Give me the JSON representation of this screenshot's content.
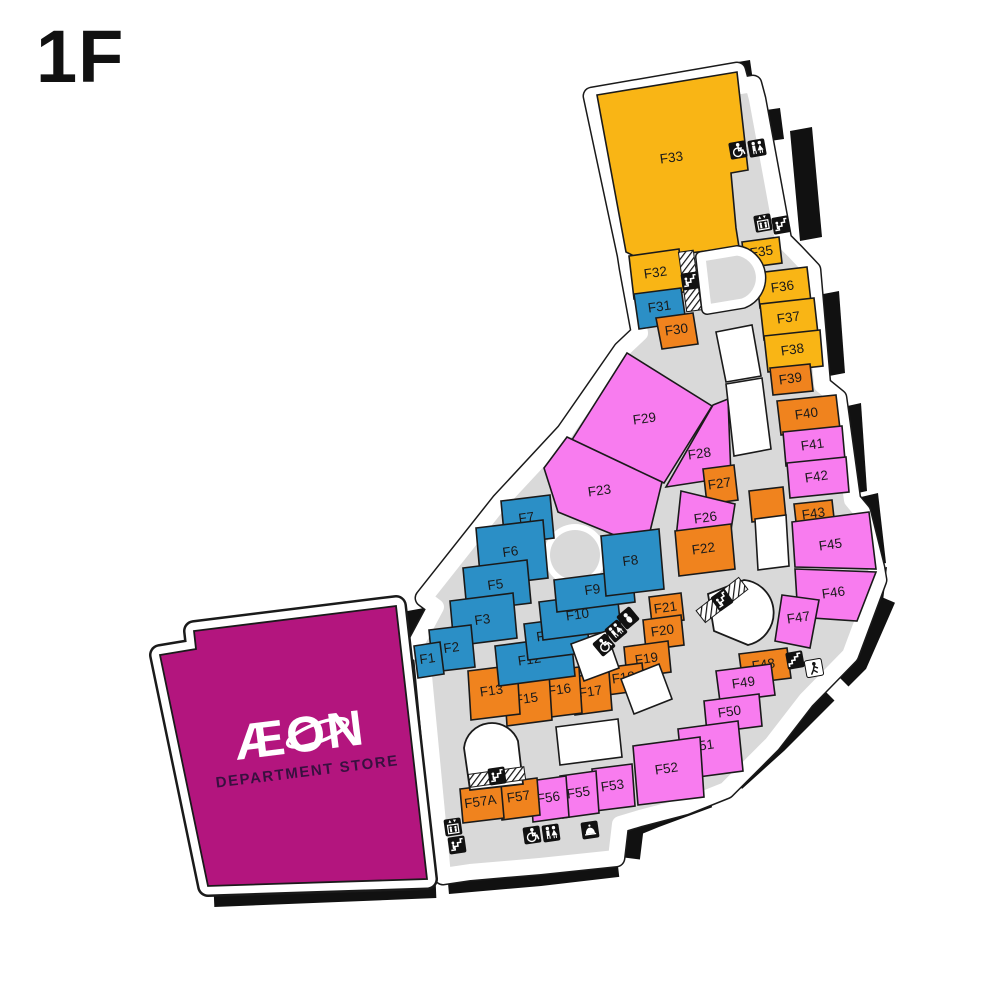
{
  "page": {
    "floor_label": "1F"
  },
  "palette": {
    "yellow": "#F9B515",
    "orange": "#F0831E",
    "blue": "#2B8FC6",
    "pink": "#F87CEF",
    "magenta": "#B3157E",
    "corridor": "#D9D9D9",
    "wall": "#111111",
    "outline": "#1A1A1A",
    "white": "#FFFFFF"
  },
  "aeon": {
    "logo": "ÆON",
    "subtitle": "DEPARTMENT STORE",
    "points": "160,655 196,649 194,631 396,606 427,879 208,886",
    "logo_x": 300,
    "logo_y": 752,
    "sub_x": 303,
    "sub_y": 777,
    "rot": -7
  },
  "footprint": {
    "points": "592,96 737,71 741,86 753,84 757,99 783,240 795,252 812,270 822,385 838,398 852,500 862,512 876,568 878,580 850,655 806,700 772,744 726,790 686,806 640,818 620,824 616,858 540,866 470,872 443,876 422,655 413,650 436,607 424,598 500,502 565,432 622,350 640,333 628,268 626,255"
  },
  "units": [
    {
      "id": "F33",
      "color": "yellow",
      "points": "597,95 737,72 748,170 731,173 736,228 739,247 640,259 626,252",
      "lx": 672,
      "ly": 162
    },
    {
      "id": "F32",
      "color": "yellow",
      "points": "629,256 679,249 684,292 634,299",
      "lx": 656,
      "ly": 277
    },
    {
      "id": "F35",
      "color": "yellow",
      "points": "742,242 779,237 782,263 745,268",
      "lx": 762,
      "ly": 256
    },
    {
      "id": "F36",
      "color": "yellow",
      "points": "756,273 807,267 811,302 760,308",
      "lx": 783,
      "ly": 291
    },
    {
      "id": "F37",
      "color": "yellow",
      "points": "760,304 814,298 818,334 764,340",
      "lx": 789,
      "ly": 322
    },
    {
      "id": "F38",
      "color": "yellow",
      "points": "764,336 820,330 823,366 768,372",
      "lx": 793,
      "ly": 354
    },
    {
      "id": "F39",
      "color": "orange",
      "points": "770,368 810,364 813,391 773,395",
      "lx": 791,
      "ly": 383
    },
    {
      "id": "F40",
      "color": "orange",
      "points": "777,401 836,395 840,429 781,435",
      "lx": 807,
      "ly": 418
    },
    {
      "id": "F41",
      "color": "pink",
      "points": "783,432 842,426 845,460 786,466",
      "lx": 813,
      "ly": 449
    },
    {
      "id": "F42",
      "color": "pink",
      "points": "787,463 846,457 849,492 790,498",
      "lx": 817,
      "ly": 481
    },
    {
      "id": "F43",
      "color": "orange",
      "points": "794,504 832,500 835,527 797,531",
      "lx": 814,
      "ly": 518
    },
    {
      "id": "F45",
      "color": "pink",
      "points": "792,522 869,512 876,569 795,567",
      "lx": 831,
      "ly": 549
    },
    {
      "id": "F46",
      "color": "pink",
      "points": "795,569 876,572 857,621 798,617",
      "lx": 834,
      "ly": 597
    },
    {
      "id": "F47",
      "color": "pink",
      "points": "782,595 819,600 810,648 775,641",
      "lx": 799,
      "ly": 622
    },
    {
      "id": "F48",
      "color": "orange",
      "points": "739,654 787,648 791,678 743,684",
      "lx": 764,
      "ly": 669
    },
    {
      "id": "F49",
      "color": "pink",
      "points": "716,671 771,664 775,695 720,702",
      "lx": 744,
      "ly": 687
    },
    {
      "id": "F50",
      "color": "pink",
      "points": "704,701 759,694 762,726 707,733",
      "lx": 730,
      "ly": 716
    },
    {
      "id": "F51",
      "color": "pink",
      "points": "678,729 738,721 743,771 683,779",
      "lx": 703,
      "ly": 750
    },
    {
      "id": "F52",
      "color": "pink",
      "points": "633,746 700,737 704,797 638,805",
      "lx": 667,
      "ly": 773
    },
    {
      "id": "F53",
      "color": "pink",
      "points": "592,769 632,764 635,806 595,811",
      "lx": 613,
      "ly": 790
    },
    {
      "id": "F55",
      "color": "pink",
      "points": "560,776 596,771 599,813 563,818",
      "lx": 579,
      "ly": 797
    },
    {
      "id": "F56",
      "color": "pink",
      "points": "530,781 566,776 569,817 533,822",
      "lx": 549,
      "ly": 802
    },
    {
      "id": "F57",
      "color": "orange",
      "points": "499,783 537,778 540,815 502,820",
      "lx": 519,
      "ly": 801
    },
    {
      "id": "F57A",
      "color": "orange",
      "points": "460,789 501,784 504,818 463,823",
      "lx": 481,
      "ly": 806,
      "small": true
    },
    {
      "id": "F29",
      "color": "pink",
      "points": "570,443 627,353 712,406 664,483",
      "lx": 645,
      "ly": 423
    },
    {
      "id": "F28",
      "color": "pink",
      "points": "713,405 728,399 731,477 666,487",
      "lx": 700,
      "ly": 458
    },
    {
      "id": "F27",
      "color": "orange",
      "points": "703,469 734,465 738,500 707,504",
      "lx": 720,
      "ly": 488
    },
    {
      "id": "F23",
      "color": "pink",
      "points": "567,437 662,482 646,548 558,512 544,468",
      "lx": 600,
      "ly": 495
    },
    {
      "id": "F26",
      "color": "pink",
      "points": "681,491 735,504 729,543 676,538",
      "lx": 706,
      "ly": 522
    },
    {
      "id": "F22",
      "color": "orange",
      "points": "675,531 731,524 735,569 679,576",
      "lx": 704,
      "ly": 553
    },
    {
      "id": "F21",
      "color": "orange",
      "points": "649,597 681,593 684,620 652,624",
      "lx": 666,
      "ly": 612
    },
    {
      "id": "F20",
      "color": "orange",
      "points": "643,620 681,615 684,645 646,650",
      "lx": 663,
      "ly": 635
    },
    {
      "id": "F19",
      "color": "orange",
      "points": "624,647 668,641 671,672 627,678",
      "lx": 647,
      "ly": 663
    },
    {
      "id": "F18",
      "color": "orange",
      "points": "604,668 642,663 645,690 607,695",
      "lx": 624,
      "ly": 682
    },
    {
      "id": "F17",
      "color": "orange",
      "points": "572,677 609,672 612,710 575,715",
      "lx": 591,
      "ly": 696
    },
    {
      "id": "F16",
      "color": "orange",
      "points": "540,672 579,667 582,713 543,718",
      "lx": 560,
      "ly": 694
    },
    {
      "id": "F15",
      "color": "orange",
      "points": "504,679 549,673 552,720 507,726",
      "lx": 527,
      "ly": 703
    },
    {
      "id": "F13",
      "color": "orange",
      "points": "468,671 517,665 520,714 471,720",
      "lx": 492,
      "ly": 695
    },
    {
      "id": "F12",
      "color": "blue",
      "points": "495,646 571,636 575,676 499,686",
      "lx": 530,
      "ly": 664
    },
    {
      "id": "F11",
      "color": "blue",
      "points": "524,624 586,616 590,652 528,660",
      "lx": 548,
      "ly": 640
    },
    {
      "id": "F10",
      "color": "blue",
      "points": "539,602 617,592 621,630 543,640",
      "lx": 578,
      "ly": 619
    },
    {
      "id": "F9",
      "color": "blue",
      "points": "554,580 632,570 635,602 557,612",
      "lx": 593,
      "ly": 594
    },
    {
      "id": "F8",
      "color": "blue",
      "points": "601,536 659,529 664,589 606,596",
      "lx": 631,
      "ly": 565
    },
    {
      "id": "F7",
      "color": "blue",
      "points": "501,501 550,495 554,538 505,544",
      "lx": 527,
      "ly": 522
    },
    {
      "id": "F6",
      "color": "blue",
      "points": "476,528 543,520 548,578 481,586",
      "lx": 511,
      "ly": 556
    },
    {
      "id": "F5",
      "color": "blue",
      "points": "463,568 527,560 531,603 467,611",
      "lx": 496,
      "ly": 589
    },
    {
      "id": "F3",
      "color": "blue",
      "points": "450,601 513,593 517,638 454,646",
      "lx": 483,
      "ly": 624
    },
    {
      "id": "F2",
      "color": "blue",
      "points": "429,630 471,625 475,667 433,672",
      "lx": 452,
      "ly": 652
    },
    {
      "id": "F1",
      "color": "blue",
      "points": "414,646 440,642 444,674 418,678",
      "lx": 428,
      "ly": 663,
      "small": true
    },
    {
      "id": "F31",
      "color": "blue",
      "points": "634,294 681,288 686,322 639,329",
      "lx": 660,
      "ly": 311
    },
    {
      "id": "F30",
      "color": "orange",
      "points": "656,318 693,313 698,344 662,349",
      "lx": 677,
      "ly": 334
    }
  ],
  "unlabeled_units": [
    {
      "color": "orange",
      "points": "749,491 783,487 786,518 752,522"
    },
    {
      "color": "white",
      "points": "716,332 752,325 761,376 726,382"
    },
    {
      "color": "white",
      "points": "726,384 762,378 771,449 734,456"
    },
    {
      "color": "white",
      "points": "755,519 786,515 789,566 758,570"
    },
    {
      "color": "white",
      "points": "571,644 606,631 619,668 584,681"
    },
    {
      "color": "white",
      "points": "621,679 659,664 672,699 634,714"
    },
    {
      "color": "white",
      "points": "556,727 618,719 622,757 560,765"
    }
  ],
  "plaza": {
    "cx": 575,
    "cy": 555,
    "r_outer": 31,
    "r_inner": 25
  },
  "wells": [
    {
      "d": "M 701,257 L 737,251 A 27 27 0 0 1 743,303 L 707,309 Z",
      "style": "ring"
    },
    {
      "d": "M 708,594 L 744,580 A 33 33 0 0 1 748,645 L 714,631 Z",
      "style": "plain"
    },
    {
      "d": "M 464,748 A 28 28 0 0 1 518,741 L 523,784 L 470,790 Z",
      "style": "plain"
    }
  ],
  "hatches": [
    {
      "x": 690,
      "y": 281,
      "w": 15,
      "h": 60,
      "rot": -8
    },
    {
      "x": 722,
      "y": 600,
      "w": 54,
      "h": 15,
      "rot": -38
    },
    {
      "x": 497,
      "y": 777,
      "w": 56,
      "h": 13,
      "rot": -8
    }
  ],
  "icons": [
    {
      "type": "wheelchair",
      "x": 738,
      "y": 150,
      "rot": -10
    },
    {
      "type": "restroom",
      "x": 757,
      "y": 148,
      "rot": -10
    },
    {
      "type": "elevator",
      "x": 763,
      "y": 223,
      "rot": -10
    },
    {
      "type": "escalator",
      "x": 781,
      "y": 225,
      "rot": -10
    },
    {
      "type": "escalator",
      "x": 690,
      "y": 281,
      "rot": -8
    },
    {
      "type": "baby",
      "x": 628,
      "y": 618,
      "rot": -40
    },
    {
      "type": "restroom",
      "x": 616,
      "y": 631,
      "rot": -40
    },
    {
      "type": "wheelchair",
      "x": 604,
      "y": 645,
      "rot": -40
    },
    {
      "type": "escalator",
      "x": 722,
      "y": 600,
      "rot": -35
    },
    {
      "type": "stairs",
      "x": 795,
      "y": 660,
      "rot": -10
    },
    {
      "type": "exit",
      "x": 814,
      "y": 668,
      "rot": -10
    },
    {
      "type": "escalator",
      "x": 497,
      "y": 776,
      "rot": -8
    },
    {
      "type": "elevator",
      "x": 453,
      "y": 827,
      "rot": -8
    },
    {
      "type": "escalator",
      "x": 457,
      "y": 845,
      "rot": -8
    },
    {
      "type": "wheelchair",
      "x": 532,
      "y": 835,
      "rot": -8
    },
    {
      "type": "restroom",
      "x": 551,
      "y": 833,
      "rot": -8
    },
    {
      "type": "bell",
      "x": 590,
      "y": 830,
      "rot": -8
    }
  ],
  "wall_polygons": [
    "726,64 750,60 754,88 730,92",
    "752,112 780,108 784,139 756,143",
    "790,131 812,127 822,237 800,241",
    "818,295 839,291 845,373 824,377",
    "843,407 861,403 867,491 849,495",
    "861,497 878,493 886,563 869,567",
    "869,571 887,567 883,601 865,605",
    "402,612 424,608 430,644 408,648"
  ],
  "wall_paths": [
    {
      "d": "M 884,598 L 856,662 L 840,678",
      "w": 24
    },
    {
      "d": "M 826,692 L 776,742 L 734,780",
      "w": 24
    },
    {
      "d": "M 708,796 L 654,816 L 632,825 L 628,858",
      "w": 24
    },
    {
      "d": "M 618,866 L 540,875 L 448,883",
      "w": 22
    },
    {
      "d": "M 436,890 L 214,899",
      "w": 16
    }
  ]
}
